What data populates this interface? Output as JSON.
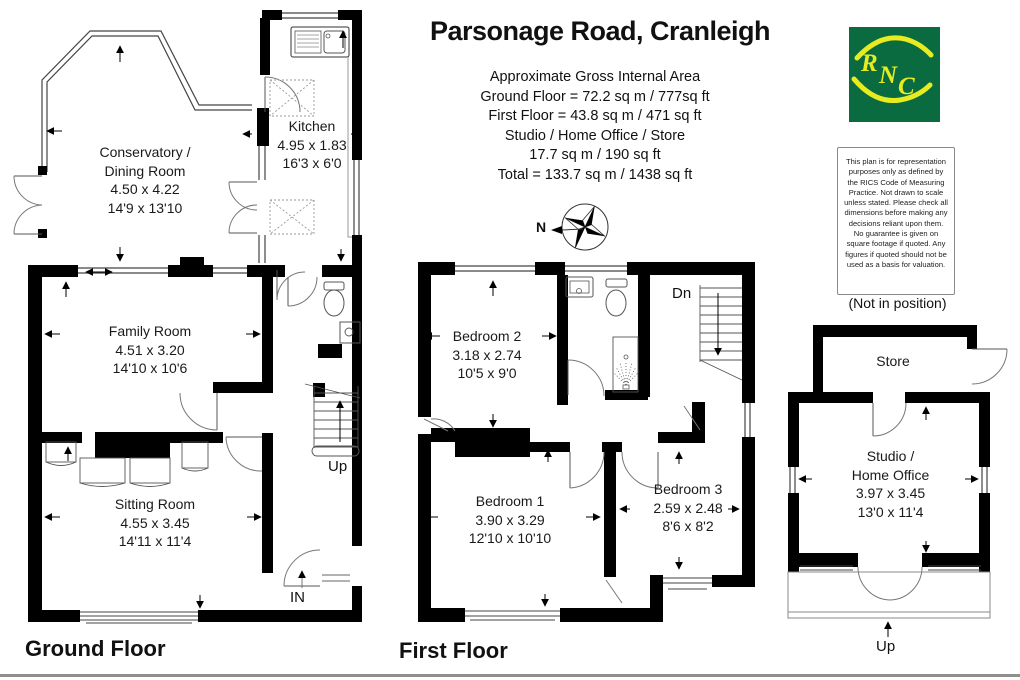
{
  "header": {
    "title": "Parsonage Road, Cranleigh",
    "area_lines": [
      "Approximate Gross Internal Area",
      "Ground Floor = 72.2 sq m / 777sq ft",
      "First Floor = 43.8 sq m / 471 sq ft",
      "Studio / Home Office / Store",
      "17.7 sq m / 190 sq ft",
      "Total = 133.7 sq m / 1438 sq ft"
    ]
  },
  "logo": {
    "letter1": "R",
    "letter2": "N",
    "letter3": "C",
    "bg_color": "#0a6b40",
    "accent_color": "#e6ec1f"
  },
  "disclaimer": {
    "text": "This plan is for representation purposes only as defined by the RICS Code of Measuring Practice. Not drawn to scale unless stated. Please check all dimensions before making any decisions reliant upon them. No guarantee is given on square footage if quoted. Any figures if quoted should not be used as a basis for valuation."
  },
  "compass": {
    "north_label": "N"
  },
  "ground_floor": {
    "label": "Ground Floor",
    "stairs_label": "Up",
    "entrance_label": "IN",
    "rooms": {
      "conservatory": {
        "lines": [
          "Conservatory /",
          "Dining Room",
          "4.50 x 4.22",
          "14'9 x 13'10"
        ]
      },
      "kitchen": {
        "lines": [
          "Kitchen",
          "4.95 x 1.83",
          "16'3 x 6'0"
        ]
      },
      "family": {
        "lines": [
          "Family Room",
          "4.51 x 3.20",
          "14'10 x 10'6"
        ]
      },
      "sitting": {
        "lines": [
          "Sitting Room",
          "4.55 x 3.45",
          "14'11 x 11'4"
        ]
      }
    }
  },
  "first_floor": {
    "label": "First Floor",
    "stairs_label": "Dn",
    "rooms": {
      "bedroom2": {
        "lines": [
          "Bedroom 2",
          "3.18 x 2.74",
          "10'5 x 9'0"
        ]
      },
      "bedroom1": {
        "lines": [
          "Bedroom 1",
          "3.90 x 3.29",
          "12'10 x 10'10"
        ]
      },
      "bedroom3": {
        "lines": [
          "Bedroom 3",
          "2.59 x 2.48",
          "8'6 x 8'2"
        ]
      }
    }
  },
  "studio": {
    "note": "(Not in position)",
    "stairs_label": "Up",
    "rooms": {
      "store": {
        "lines": [
          "Store"
        ]
      },
      "studio": {
        "lines": [
          "Studio /",
          "Home Office",
          "3.97 x 3.45",
          "13'0 x 11'4"
        ]
      }
    }
  }
}
